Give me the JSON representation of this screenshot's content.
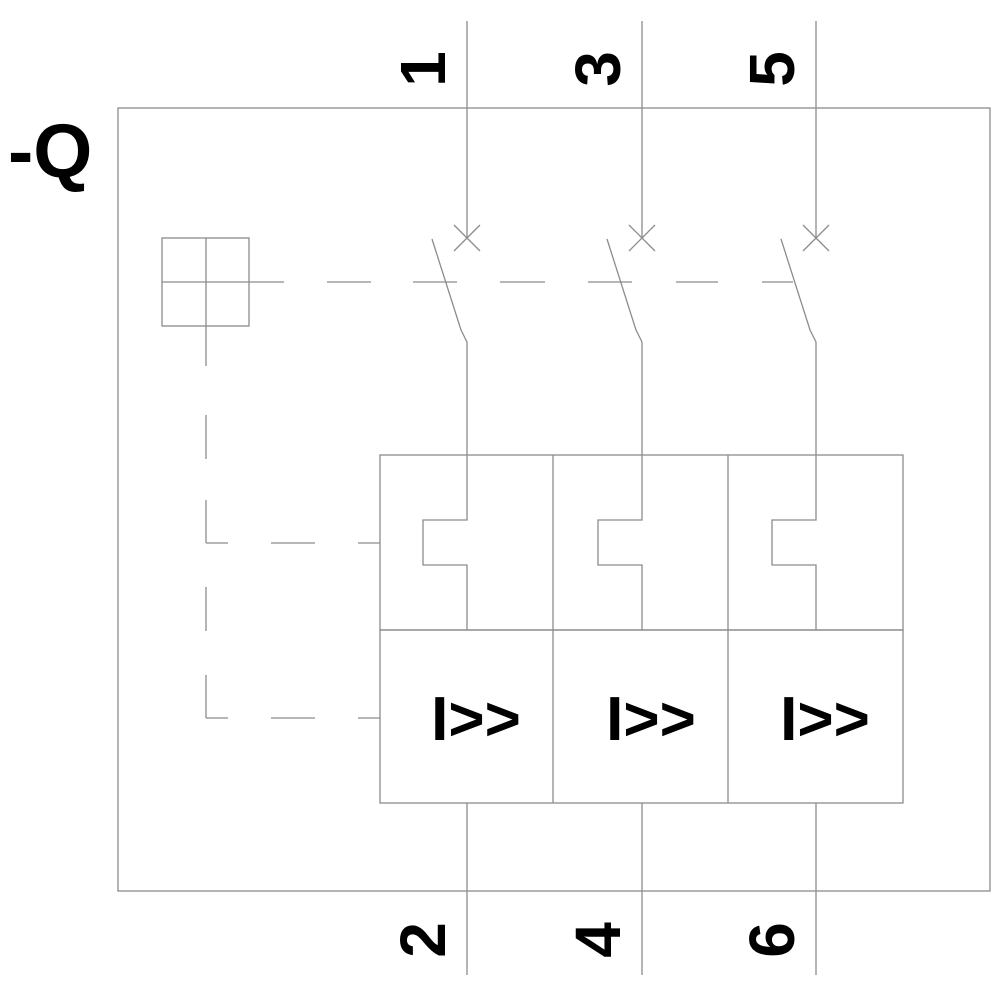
{
  "device_label": "-Q",
  "poles": [
    {
      "top_terminal": "1",
      "bottom_terminal": "2",
      "magnetic_trip_label": "I>>"
    },
    {
      "top_terminal": "3",
      "bottom_terminal": "4",
      "magnetic_trip_label": "I>>"
    },
    {
      "top_terminal": "5",
      "bottom_terminal": "6",
      "magnetic_trip_label": "I>>"
    }
  ],
  "symbols": {
    "breaker_function": "x-cross-contact",
    "manual_actuator": "crossed-square",
    "mechanical_linkage": "dashed-line",
    "thermal_overload": "rectangular-notch"
  },
  "colors": {
    "line": "#8c8c8c",
    "text": "#000000",
    "background": "#ffffff"
  }
}
